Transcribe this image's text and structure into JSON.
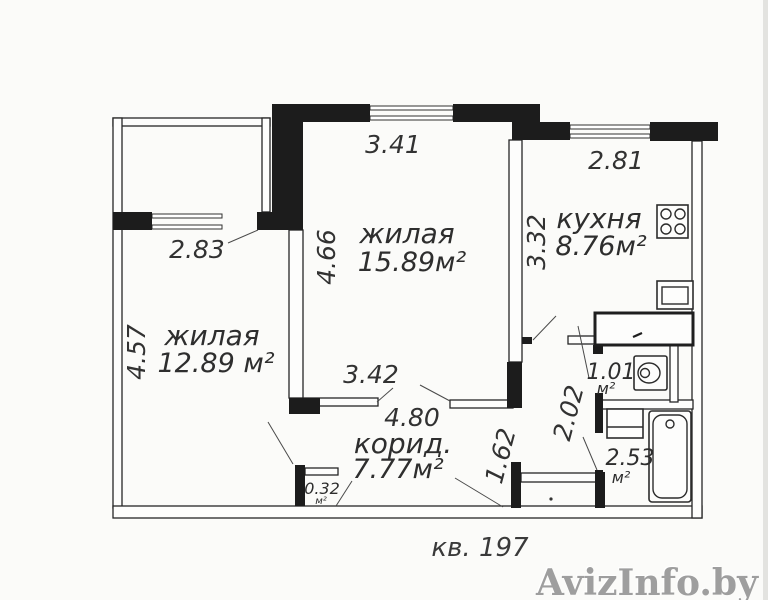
{
  "plan_title": {
    "apartment": "кв. 197"
  },
  "watermark": "AvizInfo.by",
  "rooms": {
    "living_main": {
      "name": "жилая",
      "area": "15.89м²"
    },
    "living_second": {
      "name": "жилая",
      "area": "12.89 м²"
    },
    "kitchen": {
      "name": "кухня",
      "area": "8.76м²"
    },
    "corridor": {
      "name": "корид.",
      "area": "7.77м²"
    },
    "wc": {
      "area": "1.01",
      "unit": "м²"
    },
    "bathroom": {
      "area": "2.53",
      "unit": "м²"
    },
    "closet": {
      "area": "0.32",
      "unit": "м²"
    }
  },
  "dimensions": {
    "living_main_width": "3.41",
    "kitchen_width": "2.81",
    "living_second_window": "2.83",
    "living_main_height": "4.66",
    "kitchen_height": "3.32",
    "living_second_height": "4.57",
    "living_main_bottom": "3.42",
    "corridor_length": "4.80",
    "corridor_entry": "1.62",
    "hall_height": "2.02"
  }
}
